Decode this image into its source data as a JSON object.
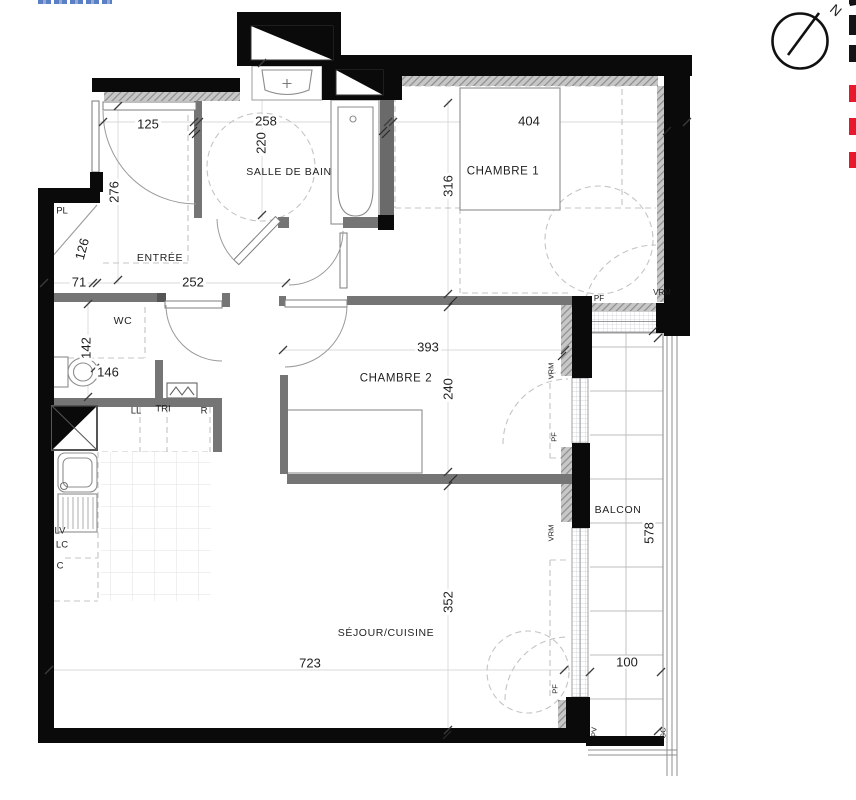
{
  "compass": {
    "north_label": "N"
  },
  "edge_marks": {
    "black_hex": "#141414",
    "red_hex": "#e8192c",
    "items": [
      {
        "hex": "#141414",
        "y": 0,
        "h": 4
      },
      {
        "hex": "#141414",
        "y": 15,
        "h": 20
      },
      {
        "hex": "#141414",
        "y": 45,
        "h": 17
      },
      {
        "hex": "#e8192c",
        "y": 85,
        "h": 17
      },
      {
        "hex": "#e8192c",
        "y": 118,
        "h": 17
      },
      {
        "hex": "#e8192c",
        "y": 152,
        "h": 16
      }
    ]
  },
  "rooms": [
    "ENTRÉE",
    "SALLE DE BAIN",
    "WC",
    "CHAMBRE 1",
    "CHAMBRE 2",
    "SÉJOUR/CUISINE",
    "BALCON"
  ],
  "dimensions_cm": [
    "125",
    "258",
    "404",
    "220",
    "316",
    "276",
    "126",
    "71",
    "252",
    "142",
    "146",
    "393",
    "240",
    "352",
    "723",
    "578",
    "100"
  ],
  "abbreviations": [
    "PL",
    "LL",
    "TRI",
    "R",
    "LV",
    "LC",
    "C",
    "PF",
    "VRM",
    "PV",
    "GC"
  ],
  "labels": [
    {
      "name": "dim-125",
      "text": "125",
      "x": 148,
      "y": 124,
      "size": 13,
      "bg": 1
    },
    {
      "name": "dim-258",
      "text": "258",
      "x": 266,
      "y": 121,
      "size": 13,
      "bg": 1
    },
    {
      "name": "dim-404",
      "text": "404",
      "x": 529,
      "y": 121,
      "size": 13,
      "bg": 1
    },
    {
      "name": "dim-220",
      "text": "220",
      "x": 261,
      "y": 143,
      "rot": -90,
      "size": 13,
      "bg": 1
    },
    {
      "name": "dim-316",
      "text": "316",
      "x": 448,
      "y": 186,
      "rot": -90,
      "size": 13,
      "bg": 1
    },
    {
      "name": "dim-276",
      "text": "276",
      "x": 114,
      "y": 192,
      "rot": -90,
      "size": 13,
      "bg": 1
    },
    {
      "name": "dim-126",
      "text": "126",
      "x": 82,
      "y": 249,
      "rot": -75,
      "size": 13,
      "bg": 1
    },
    {
      "name": "dim-71",
      "text": "71",
      "x": 79,
      "y": 282,
      "size": 13,
      "bg": 1
    },
    {
      "name": "dim-252",
      "text": "252",
      "x": 193,
      "y": 282,
      "size": 13,
      "bg": 1
    },
    {
      "name": "dim-142",
      "text": "142",
      "x": 86,
      "y": 348,
      "rot": -90,
      "size": 13,
      "bg": 1
    },
    {
      "name": "dim-146",
      "text": "146",
      "x": 108,
      "y": 372,
      "size": 13,
      "bg": 1
    },
    {
      "name": "dim-393",
      "text": "393",
      "x": 428,
      "y": 347,
      "size": 13,
      "bg": 1
    },
    {
      "name": "dim-240",
      "text": "240",
      "x": 448,
      "y": 389,
      "rot": -90,
      "size": 13,
      "bg": 1
    },
    {
      "name": "dim-352",
      "text": "352",
      "x": 448,
      "y": 602,
      "rot": -90,
      "size": 13,
      "bg": 1
    },
    {
      "name": "dim-723",
      "text": "723",
      "x": 310,
      "y": 663,
      "size": 13,
      "bg": 1
    },
    {
      "name": "dim-578",
      "text": "578",
      "x": 649,
      "y": 533,
      "rot": -90,
      "size": 13,
      "bg": 1
    },
    {
      "name": "dim-100",
      "text": "100",
      "x": 627,
      "y": 662,
      "size": 13,
      "bg": 1
    },
    {
      "name": "room-label-entree",
      "text": "ENTRÉE",
      "x": 160,
      "y": 258,
      "size": 10.5,
      "ls": 0.6
    },
    {
      "name": "room-label-salle-de-bain",
      "text": "SALLE DE BAIN",
      "x": 289,
      "y": 172,
      "size": 10.5,
      "ls": 0.6
    },
    {
      "name": "room-label-wc",
      "text": "WC",
      "x": 123,
      "y": 321,
      "size": 10.5,
      "ls": 0.6
    },
    {
      "name": "room-label-chambre-1",
      "text": "CHAMBRE 1",
      "x": 503,
      "y": 172,
      "size": 11.5,
      "ls": 0.6
    },
    {
      "name": "room-label-chambre-2",
      "text": "CHAMBRE 2",
      "x": 396,
      "y": 379,
      "size": 11.5,
      "ls": 0.6
    },
    {
      "name": "room-label-sejour-cuisine",
      "text": "SÉJOUR/CUISINE",
      "x": 386,
      "y": 633,
      "size": 10.5,
      "ls": 0.6
    },
    {
      "name": "room-label-balcon",
      "text": "BALCON",
      "x": 618,
      "y": 510,
      "size": 10.5,
      "ls": 0.6
    },
    {
      "name": "closet-label-pl",
      "text": "PL",
      "x": 62,
      "y": 211,
      "size": 9.5
    },
    {
      "name": "appliance-label-ll",
      "text": "LL",
      "x": 136,
      "y": 411,
      "size": 9.5
    },
    {
      "name": "appliance-label-tri",
      "text": "TRI",
      "x": 163,
      "y": 409,
      "size": 9.5
    },
    {
      "name": "appliance-label-r",
      "text": "R",
      "x": 204,
      "y": 411,
      "size": 9.5
    },
    {
      "name": "appliance-label-lv",
      "text": "LV",
      "x": 60,
      "y": 531,
      "size": 9.5
    },
    {
      "name": "appliance-label-lc",
      "text": "LC",
      "x": 62,
      "y": 545,
      "size": 9.5
    },
    {
      "name": "closet-label-c",
      "text": "C",
      "x": 60,
      "y": 566,
      "size": 9.5
    },
    {
      "name": "window-label-pf-chambre1",
      "text": "PF",
      "x": 599,
      "y": 299,
      "size": 8
    },
    {
      "name": "window-label-vrm-chambre1",
      "text": "VRM",
      "x": 662,
      "y": 293,
      "size": 8
    },
    {
      "name": "window-label-vrm-chambre2",
      "text": "VRM",
      "x": 551,
      "y": 371,
      "rot": -90,
      "size": 7.5
    },
    {
      "name": "window-label-pf-chambre2",
      "text": "PF",
      "x": 554,
      "y": 437,
      "rot": -90,
      "size": 7.5
    },
    {
      "name": "window-label-vrm-sejour",
      "text": "VRM",
      "x": 551,
      "y": 533,
      "rot": -90,
      "size": 7.5
    },
    {
      "name": "window-label-pf-sejour",
      "text": "PF",
      "x": 555,
      "y": 689,
      "rot": -90,
      "size": 7.5
    },
    {
      "name": "balcony-label-pv",
      "text": "PV",
      "x": 594,
      "y": 732,
      "rot": -90,
      "size": 7.5
    },
    {
      "name": "balcony-label-gc",
      "text": "GC",
      "x": 663,
      "y": 733,
      "rot": -90,
      "size": 7.5
    },
    {
      "name": "compass-north-label",
      "text": "N",
      "x": 836,
      "y": 10,
      "rot": 40,
      "size": 14
    }
  ]
}
